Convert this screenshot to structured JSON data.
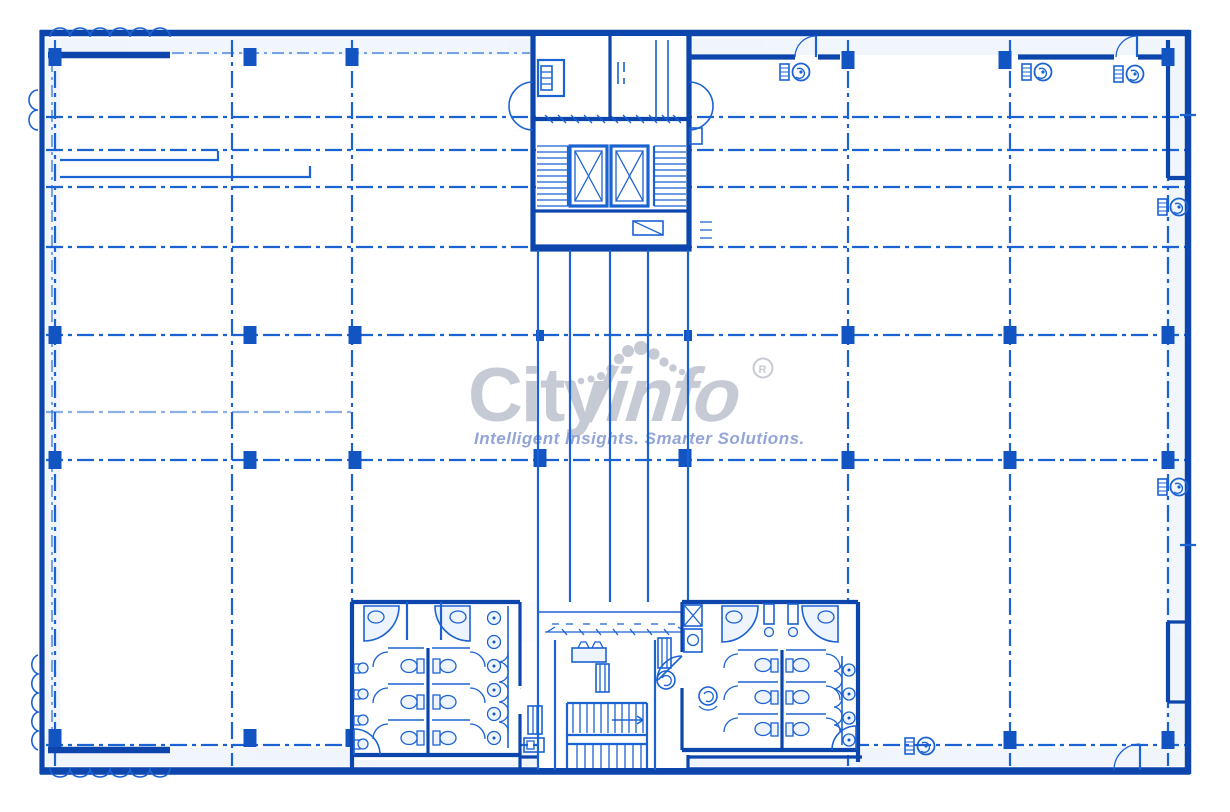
{
  "watermark": {
    "brand_city": "City",
    "brand_info": "/info",
    "registered_mark": "R",
    "tagline": "Intelligent Insights. Smarter Solutions."
  },
  "colors": {
    "background": "#ffffff",
    "line-blue": "#1b62d3",
    "wall-dark": "#0c46ad",
    "column-fill": "#1254c2",
    "wash-light": "#dfeafa",
    "watermark-gray": "#c6cad5",
    "tagline-blue": "#93a5d6"
  },
  "plan": {
    "type": "architectural-floor-plan-blueprint",
    "features": [
      "structural-column-grid",
      "dashed-axis-gridlines",
      "elevator-core-with-twin-shafts",
      "core-scissor-stairs",
      "central-service-stair",
      "mens-restroom-block",
      "womens-restroom-block",
      "wash-basin-counters",
      "toilet-stalls",
      "swing-doors",
      "exhaust-fan-units",
      "castellated-wall-details"
    ],
    "column_grid": {
      "column_rows": 4,
      "column_columns": 6
    }
  }
}
